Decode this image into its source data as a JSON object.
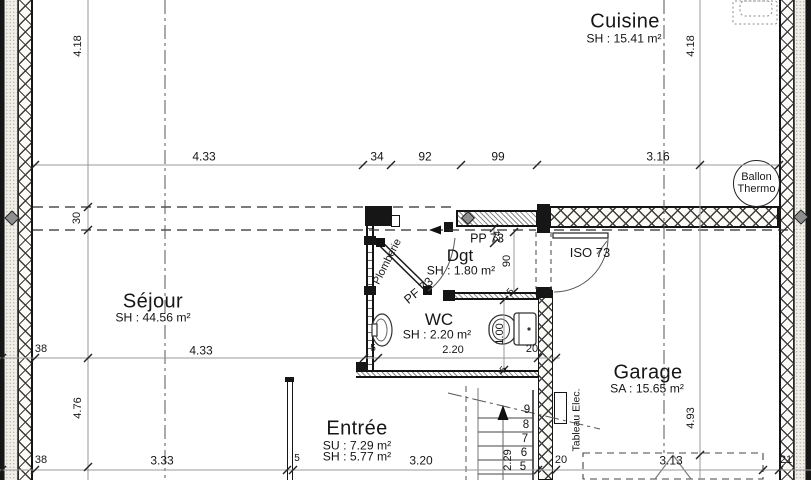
{
  "rooms": {
    "cuisine": {
      "name": "Cuisine",
      "area": "SH : 15.41 m²"
    },
    "sejour": {
      "name": "Séjour",
      "area": "SH : 44.56 m²"
    },
    "dgt": {
      "name": "Dgt",
      "area": "SH : 1.80 m²"
    },
    "wc": {
      "name": "WC",
      "area": "SH : 2.20 m²"
    },
    "entree": {
      "name": "Entrée",
      "su": "SU : 7.29 m²",
      "sh": "SH : 5.77 m²"
    },
    "garage": {
      "name": "Garage",
      "area": "SA : 15.65 m²"
    }
  },
  "annotations": {
    "ballon_line1": "Ballon",
    "ballon_line2": "Thermo",
    "plomberie": "Plomberie",
    "tableau_elec": "Tableau Elec.",
    "door_pp": "PP 73",
    "door_pf": "PF 73",
    "door_iso": "ISO 73"
  },
  "dims": {
    "v_left_top": "4.18",
    "v_right_top": "4.18",
    "v_left_30": "30",
    "v_left_bottom": "4.76",
    "v_garage": "4.93",
    "v_dgt": "90",
    "v_dgt_wall": "5",
    "v_wc": "1.00",
    "v_wc_wall": "5",
    "v_pp": "24",
    "stair_run": "2.29",
    "row_top": {
      "a": "4.33",
      "b": "34",
      "c": "92",
      "d": "99",
      "e": "3.16"
    },
    "row_mid": {
      "a": "38",
      "b": "4.33",
      "c": "5",
      "d": "2.20",
      "e": "20"
    },
    "row_bot": {
      "a": "38",
      "b": "3.33",
      "c": "5",
      "d": "3.20",
      "e": "20",
      "f": "3.13",
      "g": "21"
    }
  },
  "stairs": {
    "s9": "9",
    "s8": "8",
    "s7": "7",
    "s6": "6",
    "s5": "5"
  }
}
